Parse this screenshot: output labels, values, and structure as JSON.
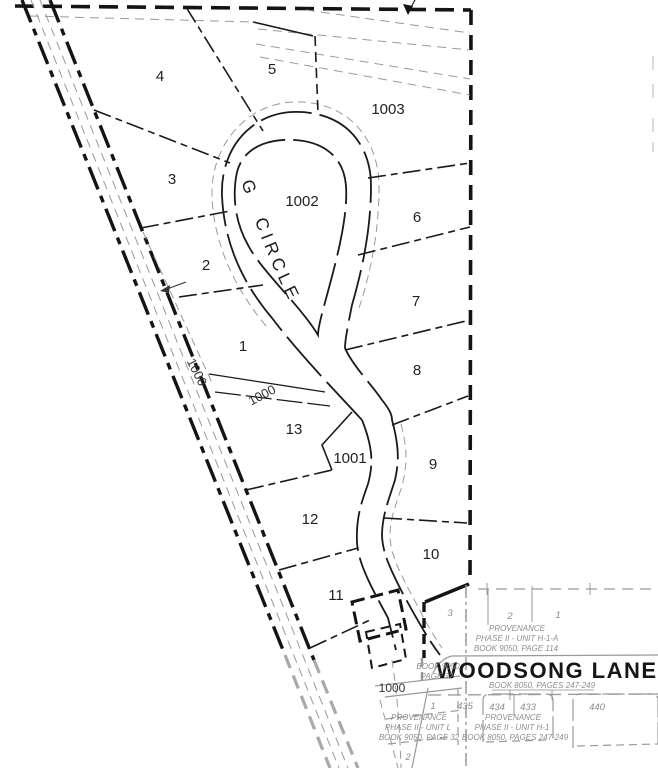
{
  "roads": {
    "woodsong_circle": "WOODSONG CIRCLE",
    "woodsong_lane": "WOODSONG LANE"
  },
  "lots": {
    "lot_1": "1",
    "lot_2": "2",
    "lot_3": "3",
    "lot_4": "4",
    "lot_5": "5",
    "lot_6": "6",
    "lot_7": "7",
    "lot_8": "8",
    "lot_9": "9",
    "lot_10": "10",
    "lot_11": "11",
    "lot_12": "12",
    "lot_13": "13",
    "lot_1001": "1001",
    "lot_1002": "1002",
    "lot_1003": "1003"
  },
  "common_area": {
    "label": "1000"
  },
  "adjacent": {
    "h1a": {
      "name": "PROVENANCE",
      "phase": "PHASE II - UNIT H-1-A",
      "book": "BOOK 9050, PAGE 114",
      "lots": [
        "3",
        "2",
        "1"
      ]
    },
    "h1": {
      "name": "PROVENANCE",
      "phase": "PHASE II - UNIT H-1",
      "book": "BOOK 8050, PAGES 247-249",
      "lots": [
        "435",
        "434",
        "433",
        "440"
      ]
    },
    "unit_l": {
      "name": "PROVENANCE",
      "phase": "PHASE II - UNIT L",
      "book": "BOOK 9050, PAGE 32",
      "lots": [
        "1",
        "2"
      ]
    },
    "lane_book": "BOOK 8050, PAGES 247-249",
    "book_ref": [
      "BOOK 9050",
      "PAGE 32"
    ]
  }
}
